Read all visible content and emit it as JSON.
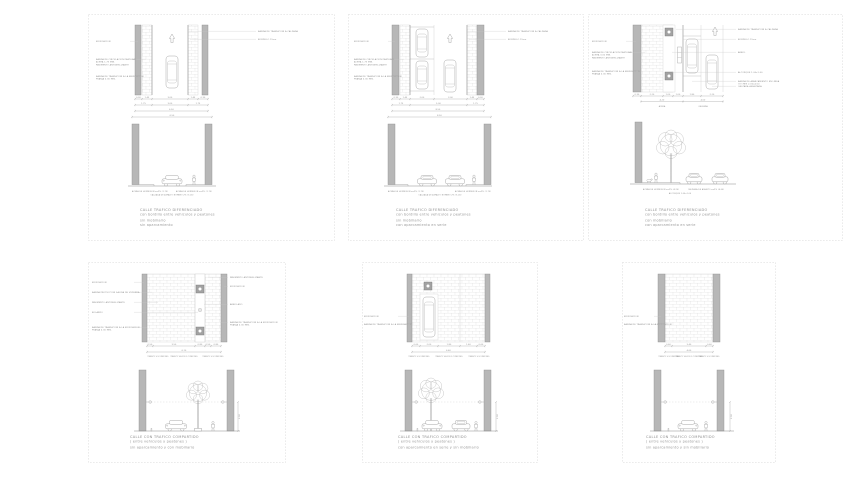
{
  "page": {
    "background": "#ffffff"
  },
  "colors": {
    "line": "#9e9e9e",
    "line_soft": "#c6c6c6",
    "wall_fill": "#b7b7b7",
    "wall_edge": "#8f8f8f",
    "brick_line": "#dedede",
    "text": "#8e8e8e",
    "caption": "#9b9b9b",
    "sheet_border": "#cdcdcd",
    "planter_fill": "#a2a2a2"
  },
  "sheets": [
    {
      "name": "calle-trafico-diferenciado-1",
      "caption": {
        "title": "CALLE TRAFICO DIFERENCIADO",
        "line2": "con bordillo entre vehiculos y peatones",
        "line3": "sin mobiliario",
        "line4": "sin aparcamiento"
      },
      "labels_left": [
        [
          "EDIFICACION"
        ],
        [
          "BANDA DE CIRCULACION PEATONAL",
          "ACERA 1.75 MIN.",
          "PAVIMENTO ANTIDESLIZANTE"
        ],
        [
          "BANDA DE TRANSICION A LA EDIFICACION",
          "FRANJA 0.30 MIN."
        ]
      ],
      "labels_right": [
        [
          "BANDA DE TRANSICION A CALZADA"
        ],
        [
          "BORDILLO 15cm"
        ]
      ],
      "dim_rows": [
        [
          "0.30",
          "1.45",
          "3.00",
          "1.45",
          "0.30"
        ],
        [
          "1.75",
          "3.00",
          "1.75"
        ],
        [
          "6.50"
        ]
      ],
      "elev_dim": "6.50",
      "ground_labels": [
        "ACERA DE HORMIGON s=2% (1.75)",
        "CALZADA DE ASFALTO BOMBEO 2% (3.00)",
        "ACERA DE HORMIGON s=2% (1.75)"
      ]
    },
    {
      "name": "calle-trafico-diferenciado-2",
      "caption": {
        "title": "CALLE TRAFICO DIFERENCIADO",
        "line2": "con bordillo entre vehiculos y peatones",
        "line3": "sin mobiliario",
        "line4": "con aparcamiento en serie"
      },
      "labels_left": [
        [
          "EDIFICACION"
        ],
        [
          "BANDA DE CIRCULACION PEATONAL",
          "ACERA 1.75 MIN.",
          "PAVIMENTO ANTIDESLIZANTE"
        ],
        [
          "BANDA DE TRANSICION A LA EDIFICACION",
          "FRANJA 0.30 MIN."
        ]
      ],
      "labels_right": [
        [
          "BANDA DE TRANSICION A CALZADA"
        ],
        [
          "BORDILLO 15cm"
        ]
      ],
      "dim_rows": [
        [
          "0.30",
          "1.45",
          "2.00",
          "3.00",
          "1.45",
          "0.30"
        ],
        [
          "1.75",
          "5.00",
          "1.75"
        ],
        [
          "8.50"
        ]
      ],
      "elev_dim": "8.50",
      "ground_labels": [
        "ACERA DE HORMIGON s=2% (1.75)",
        "CALZADA DE ASFALTO BOMBEO 2% (5.00)",
        "ACERA DE HORMIGON s=2% (1.75)"
      ]
    },
    {
      "name": "calle-trafico-diferenciado-3",
      "caption": {
        "title": "CALLE TRAFICO DIFERENCIADO",
        "line2": "con bordillo entre vehiculos y peatones",
        "line3": "con mobiliario",
        "line4": "con aparcamiento en serie"
      },
      "labels_left": [
        [
          "EDIFICACION"
        ],
        [
          "BANDA DE CIRCULACION PEATONAL",
          "ACERA 3.00 MIN.",
          "PAVIMENTO ANTIDESLIZANTE"
        ],
        [
          "BANDA DE TRANSICION A LA EDIFICACION",
          "FRANJA 0.30 MIN."
        ]
      ],
      "labels_right": [
        [
          "BANDA DE TRANSICION A CALZADA"
        ],
        [
          "BORDILLO 15cm"
        ],
        [
          "ARBOL"
        ],
        [
          "ALCORQUE 1.00x1.00"
        ],
        [
          "BANDA DE APARCAMIENTO EN LINEA",
          "COCHES 2.00x4.50"
        ],
        [
          "CALZADA ASFALTADA"
        ]
      ],
      "dim_rows": [
        [
          "0.30",
          "2.20",
          "1.00",
          "1.00",
          "1.80",
          "2.20"
        ],
        [
          "4.20",
          "4.00"
        ]
      ],
      "dim_texts": [
        "ACERA",
        "CALZADA"
      ],
      "ground_labels": [
        "ACERA DE HORMIGON s=2% (4.20)",
        "CALZADA DE ASFALTO s=2% (4.00)",
        "ALCORQUE 1.00x1.00"
      ]
    },
    {
      "name": "calle-trafico-compartido-1",
      "caption": {
        "title": "CALLE CON TRAFICO COMPARTIDO",
        "line2": "( entre vehiculos y peatones )",
        "line3": "sin aparcamiento y con mobiliario",
        "line4": ""
      },
      "labels_left": [
        [
          "EDIFICACION"
        ],
        [
          "BANDA PROTECCION SALIDA DE VIVIENDA"
        ],
        [
          "PAVIMENTO ANTIDESLIZANTE"
        ],
        [
          "BOLARDO"
        ],
        [
          "BANDA DE TRANSICION A LA EDIFICACION",
          "FRANJA 0.30 MIN."
        ]
      ],
      "labels_right": [
        [
          "PAVIMENTO ANTIDESLIZANTE"
        ],
        [
          "EDIFICACION"
        ],
        [
          "ARBOLADO"
        ],
        [
          "BANDA DE TRANSICION A LA EDIFICACION",
          "FRANJA 0.30 MIN."
        ]
      ],
      "dim_rows": [
        [
          "0.50",
          "3.50",
          "0.80",
          "0.50",
          "0.80"
        ],
        [
          "6.10"
        ]
      ],
      "band_labels": [
        "TRANSITO SOLO PEATONES",
        "TRANSITO VEHICULOS Y PEATONES",
        "TRANSITO SOLO PEATONES"
      ],
      "elev_dim_right": "2.50"
    },
    {
      "name": "calle-trafico-compartido-2",
      "caption": {
        "title": "CALLE CON TRAFICO COMPARTIDO",
        "line2": "( entre vehiculos y peatones )",
        "line3": "con aparcamiento en serie y sin mobiliario",
        "line4": ""
      },
      "labels_left": [
        [
          "EDIFICACION"
        ],
        [
          "BANDA DE TRANSICION A LA EDIFICACION"
        ]
      ],
      "dim_rows": [
        [
          "0.60",
          "2.00",
          "1.80",
          "1.40",
          "0.60"
        ],
        [
          "6.40"
        ]
      ],
      "band_labels": [
        "TRANSITO SOLO PEATONES",
        "TRANSITO VEHICULOS Y PEATONES",
        "TRANSITO SOLO PEATONES"
      ],
      "elev_dim_right": "2.50"
    },
    {
      "name": "calle-trafico-compartido-3",
      "caption": {
        "title": "CALLE CON TRAFICO COMPARTIDO",
        "line2": "( entre vehiculos y peatones )",
        "line3": "sin aparcamiento y sin mobiliario",
        "line4": ""
      },
      "labels_left": [
        [
          "EDIFICACION"
        ],
        [
          "BANDA DE TRANSICION A LA EDIFICACION"
        ]
      ],
      "dim_rows": [
        [
          "0.60",
          "3.40",
          "0.60"
        ],
        [
          "4.60"
        ]
      ],
      "band_labels": [
        "TRANSITO SOLO PEATONES",
        "TRANSITO VEHICULOS Y PEATONES",
        "TRANSITO SOLO PEATONES"
      ],
      "elev_dim_right": "2.50"
    }
  ]
}
